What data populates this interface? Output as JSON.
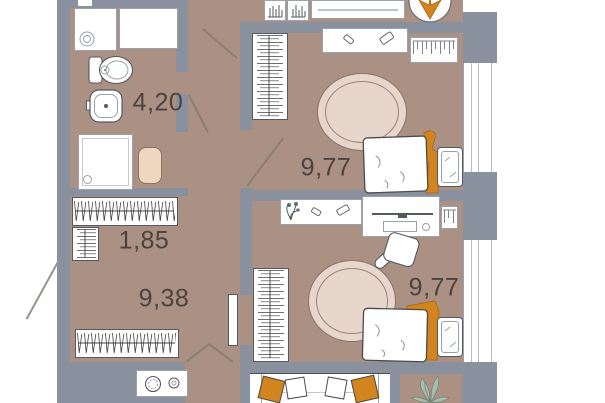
{
  "title": "Apartment floor plan",
  "rooms": [
    {
      "name": "bathroom",
      "area_label": "4,20"
    },
    {
      "name": "closet",
      "area_label": "1,85"
    },
    {
      "name": "hallway",
      "area_label": "9,38"
    },
    {
      "name": "bedroom-1",
      "area_label": "9,77"
    },
    {
      "name": "bedroom-2",
      "area_label": "9,77"
    }
  ],
  "furniture": [
    "washing-machine",
    "countertop",
    "toilet",
    "sink",
    "shower",
    "bath-mat",
    "clothes-rail",
    "storage-rack",
    "coat-rack",
    "wardrobe",
    "dresser",
    "radiator",
    "rug",
    "bed",
    "nightstand",
    "console-shelf",
    "desk",
    "desk-chair",
    "door-leaf",
    "sofa",
    "pillows",
    "stove",
    "potted-plant",
    "bookshelf",
    "window"
  ],
  "colors": {
    "background": "#ffffff",
    "floor": "#ab9084",
    "wall": "#8a919e",
    "accent_orange": "#d2841e",
    "rug": "#e7d6cb",
    "rug_outline": "#8c7468",
    "bath_mat": "#eed6c0",
    "plant_green": "#7f9a8a",
    "outline_dark": "#4c4c4a",
    "furniture_outline": "#9aa1ab",
    "label_text": "#4b433d"
  }
}
